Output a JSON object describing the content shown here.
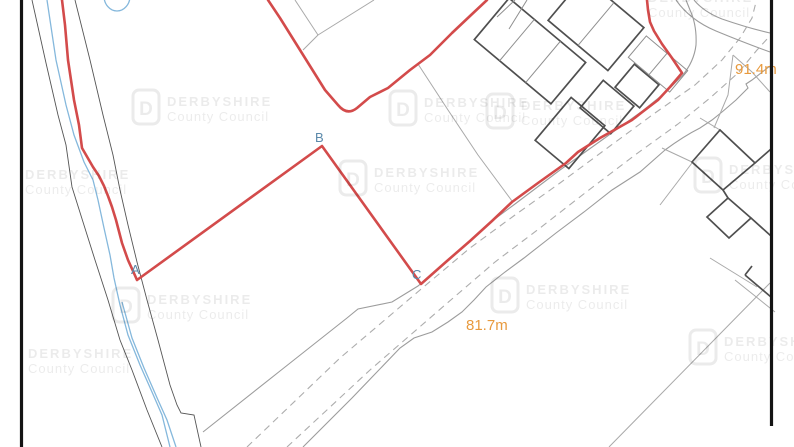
{
  "map": {
    "vertex_labels": [
      "A",
      "B",
      "C"
    ],
    "spot_heights": [
      {
        "label": "81.7m"
      },
      {
        "label": "91.4m"
      }
    ],
    "watermark": {
      "logo_letter": "D",
      "line1": "DERBYSHIRE",
      "line2": "County Council"
    },
    "colors": {
      "boundary_red": "#d34b4b",
      "water_blue": "#85b8dc",
      "spot_orange": "#e89a3e",
      "label_blue": "#5b89aa",
      "road_gray": "#9c9c9c",
      "building_dark": "#4f4f4f",
      "border_black": "#141414",
      "watermark_gray": "rgba(0,0,0,0.08)"
    }
  }
}
